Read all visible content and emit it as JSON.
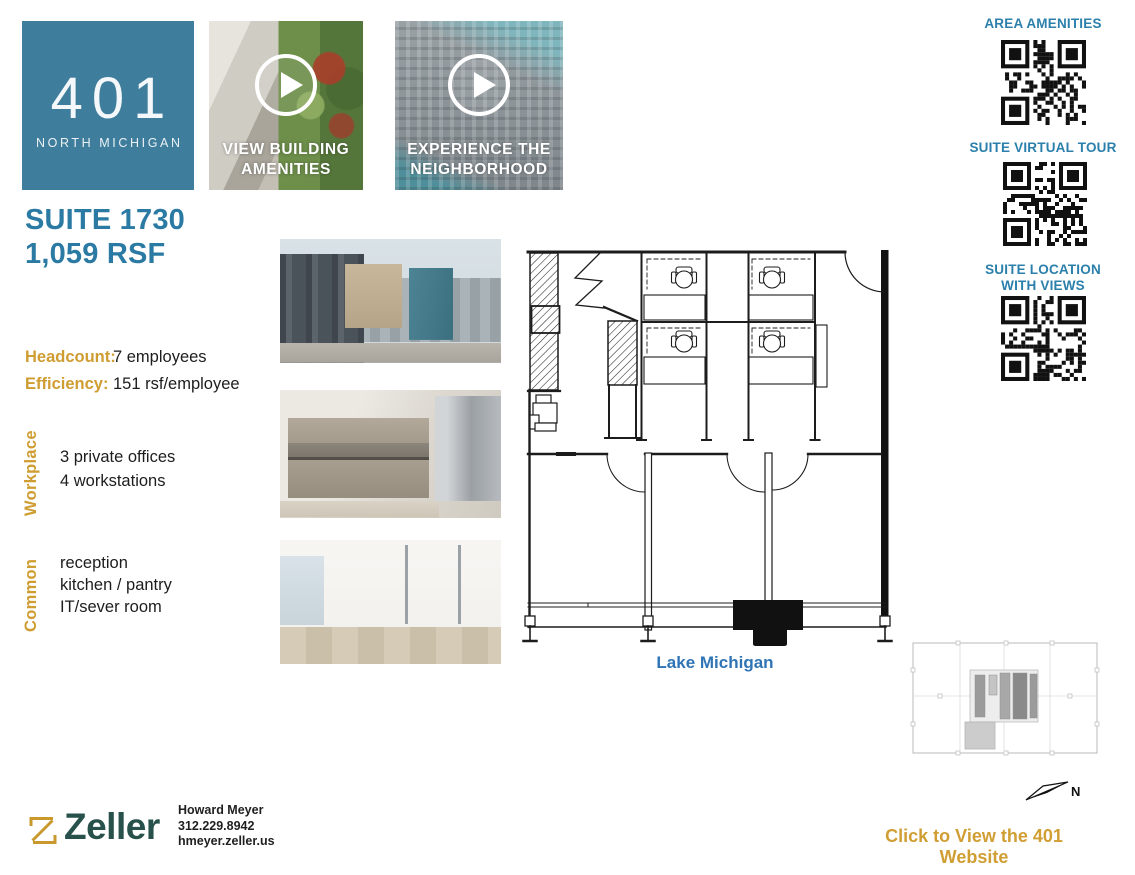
{
  "colors": {
    "header_blue": "#3f7d9d",
    "accent_blue": "#2a7aa3",
    "gold": "#cf9d31",
    "link_gold": "#d09e33",
    "map_blue": "#2f74b5",
    "brand_green": "#27514a",
    "qr_label_blue": "#2b80ab"
  },
  "header": {
    "building_number": "401",
    "building_name": "NORTH MICHIGAN",
    "videos": [
      {
        "line1": "VIEW BUILDING",
        "line2": "AMENITIES"
      },
      {
        "line1": "EXPERIENCE THE",
        "line2": "NEIGHBORHOOD"
      }
    ]
  },
  "qr_panel": {
    "items": [
      {
        "label": "AREA AMENITIES"
      },
      {
        "label": "SUITE VIRTUAL TOUR"
      },
      {
        "label": "SUITE LOCATION",
        "label2": "WITH VIEWS"
      }
    ]
  },
  "suite": {
    "title": "SUITE 1730",
    "size": "1,059 RSF",
    "stats": [
      {
        "label": "Headcount:",
        "value": "7 employees"
      },
      {
        "label": "Efficiency:",
        "value": "151 rsf/employee"
      }
    ],
    "sections": [
      {
        "label": "Workplace",
        "items": [
          "3 private offices",
          "4 workstations"
        ]
      },
      {
        "label": "Common",
        "items": [
          "reception",
          "kitchen / pantry",
          "IT/sever room"
        ]
      }
    ]
  },
  "floorplan": {
    "caption": "Lake Michigan",
    "north_label": "N"
  },
  "footer": {
    "brand": "Zeller",
    "contact": {
      "name": "Howard Meyer",
      "phone": "312.229.8942",
      "email": "hmeyer.zeller.us"
    },
    "website_link": "Click to View the 401 Website"
  }
}
